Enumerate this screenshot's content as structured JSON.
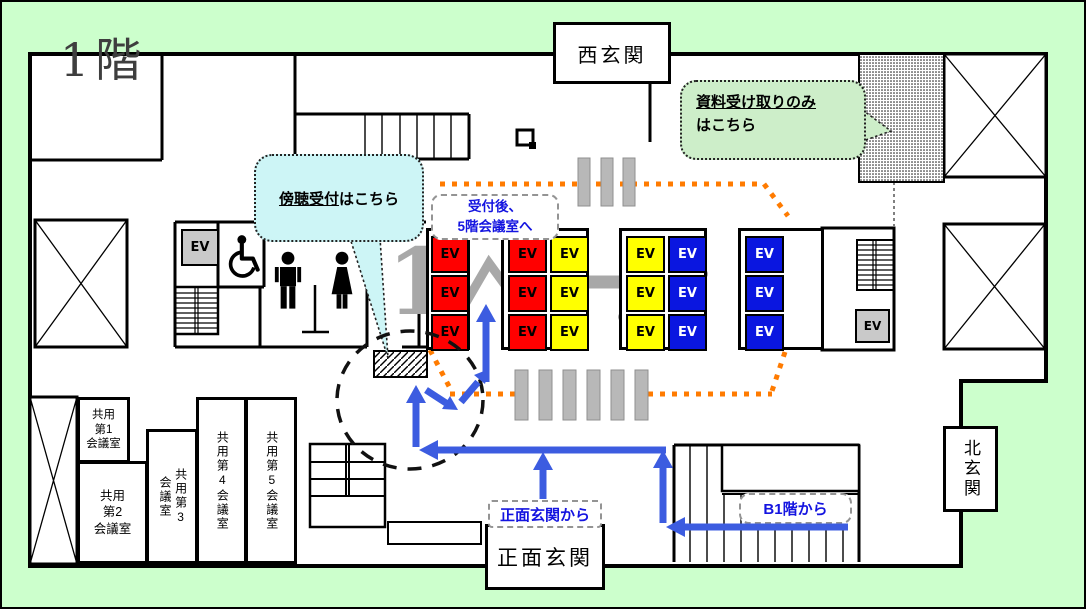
{
  "floor_title": "1階",
  "watermark_digit": "1",
  "entrances": {
    "west": "西玄関",
    "north": "北玄関",
    "main": "正面玄関"
  },
  "callouts": {
    "audience_reception": {
      "highlight": "傍聴受付",
      "rest": "はこちら"
    },
    "document_pickup": {
      "highlight": "資料受け取りのみ",
      "rest": "はこちら"
    },
    "after_reception": {
      "line1": "受付後、",
      "line2": "5階会議室へ"
    }
  },
  "route_labels": {
    "from_main_entrance": "正面玄関から",
    "from_b1": "B1階から"
  },
  "meeting_rooms": {
    "room1": "共用\n第1\n会議室",
    "room2": "共用\n第2\n会議室",
    "room3": "共用第3\n会議室",
    "room4": "共用第4会議室",
    "room5": "共用第5会議室"
  },
  "elevator_label": "EV",
  "colors": {
    "background_green": "#ccffcc",
    "bubble_cyan": "#cdf5f6",
    "bubble_green": "#cdeec9",
    "ev_red": "#ff0000",
    "ev_yellow": "#ffff00",
    "ev_blue": "#0a16e0",
    "route_blue": "#3c5ce0",
    "route_orange": "#ff7b00",
    "watermark_gray": "#a8a8a8"
  }
}
